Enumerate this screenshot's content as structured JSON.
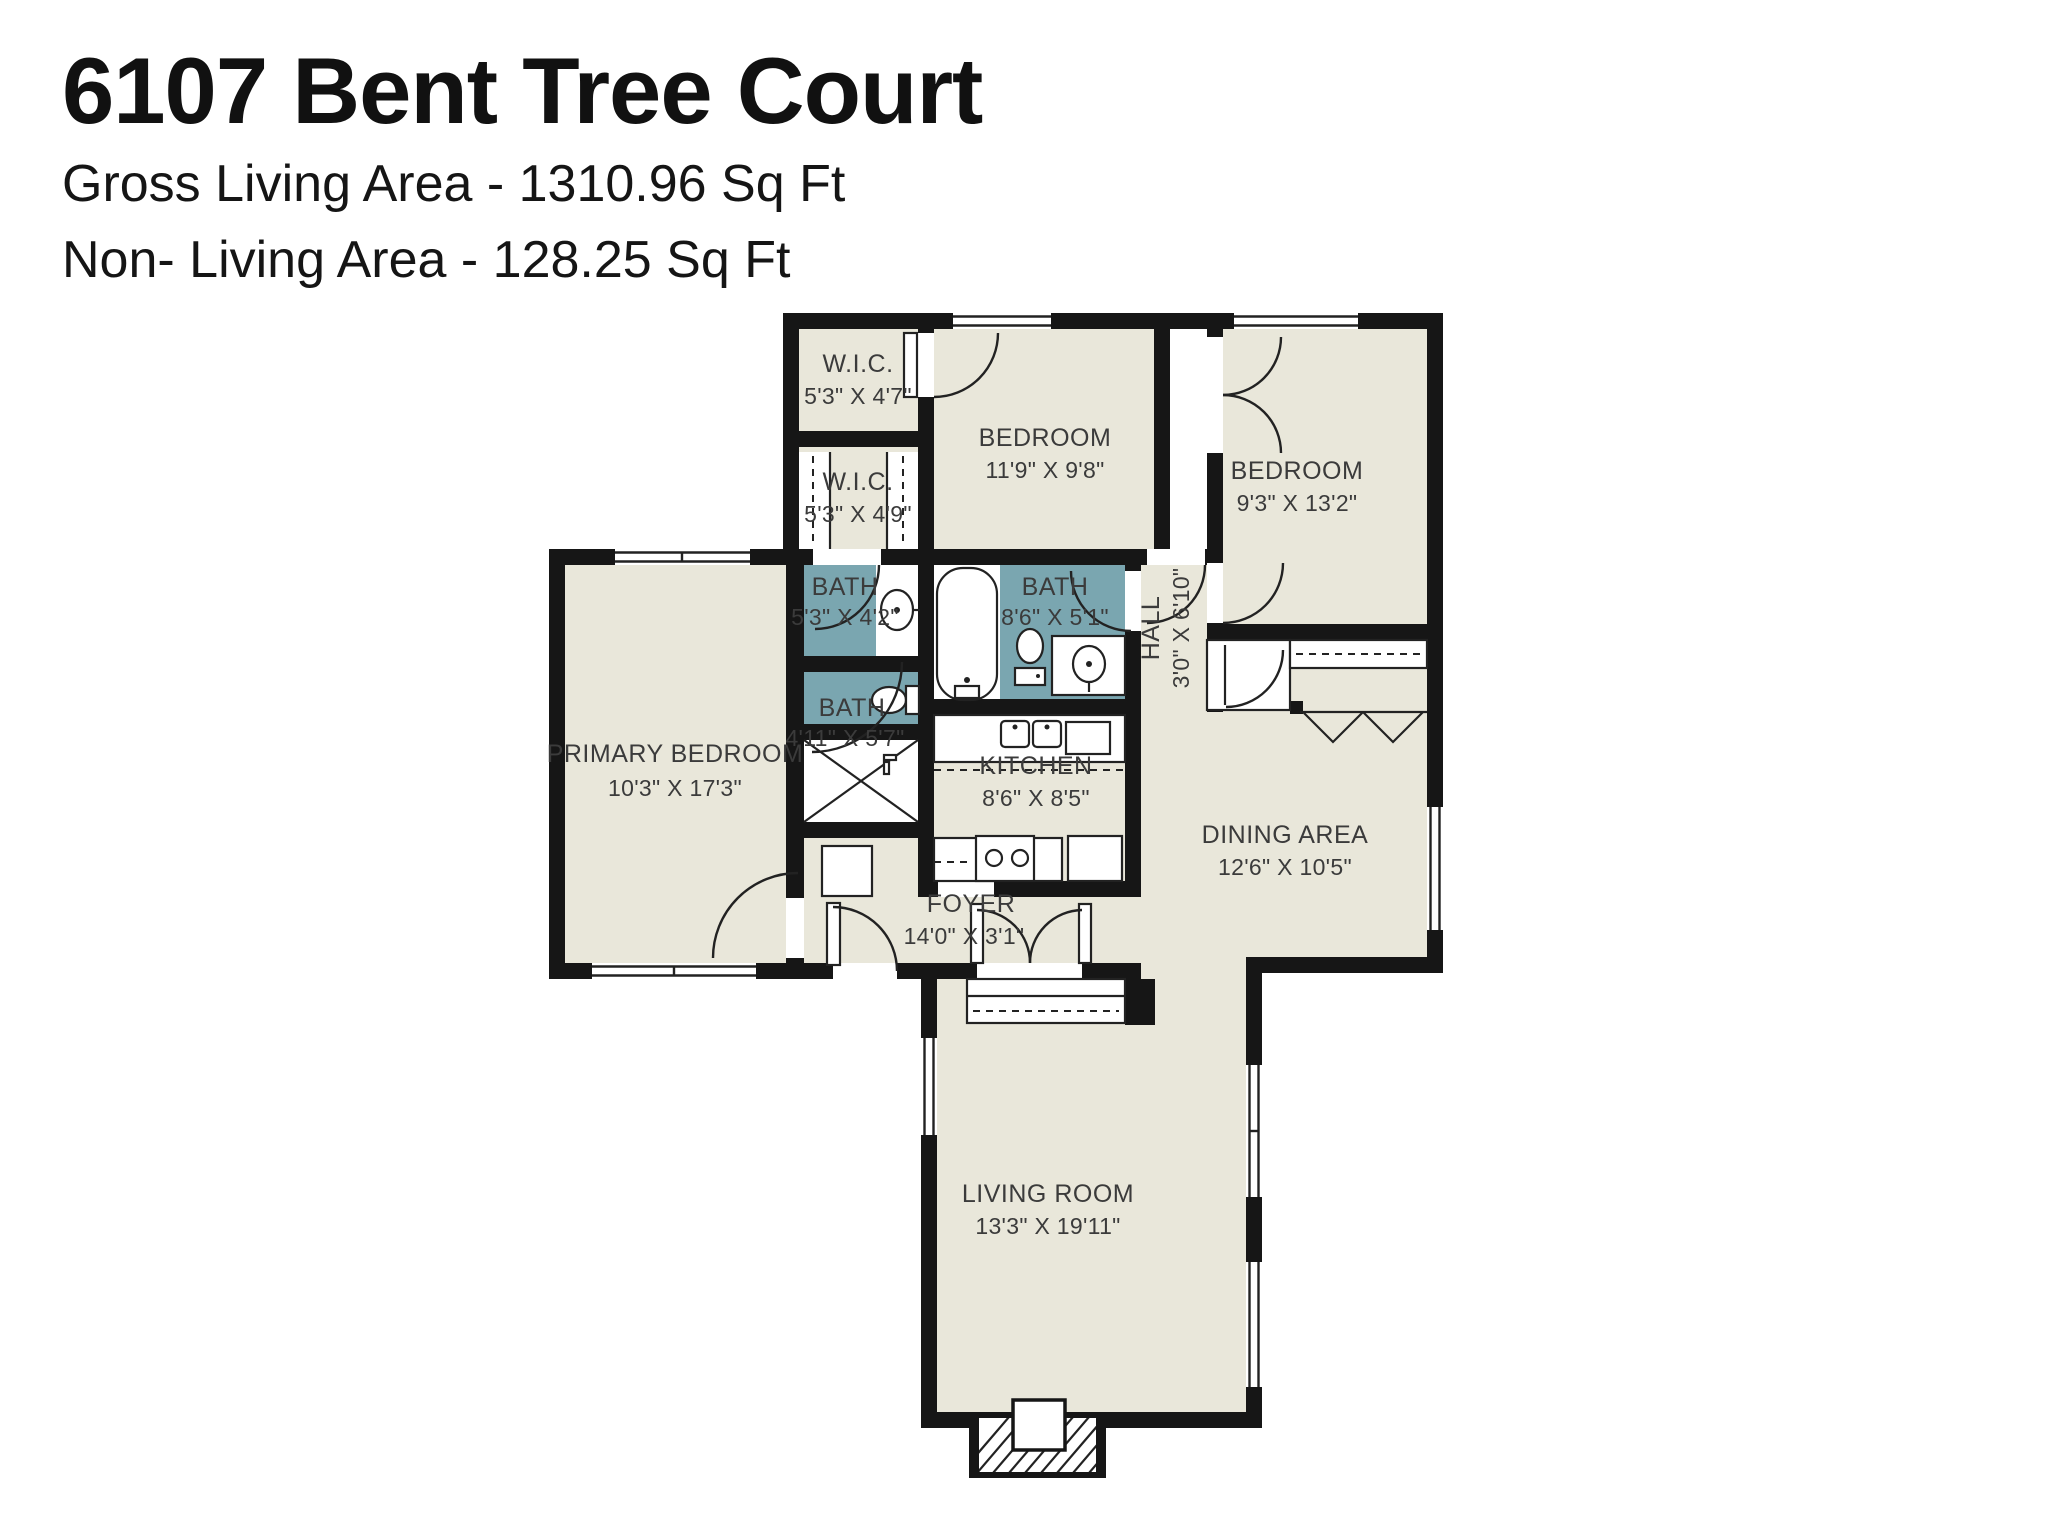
{
  "header": {
    "title": "6107 Bent Tree Court",
    "gross_line": "Gross Living Area - 1310.96 Sq Ft",
    "non_living_line": "Non- Living Area - 128.25 Sq Ft"
  },
  "colors": {
    "wall": "#161616",
    "floor": "#e9e7da",
    "bath_fill": "#7aa6b0",
    "label_text": "#3b3b3b",
    "background": "#ffffff"
  },
  "rooms": [
    {
      "id": "wic-upper",
      "name": "W.I.C.",
      "dims": "5'3\" X 4'7\""
    },
    {
      "id": "bedroom-top",
      "name": "BEDROOM",
      "dims": "11'9\" X 9'8\""
    },
    {
      "id": "bedroom-right",
      "name": "BEDROOM",
      "dims": "9'3\" X 13'2\""
    },
    {
      "id": "wic-lower",
      "name": "W.I.C.",
      "dims": "5'3\" X 4'9\""
    },
    {
      "id": "bath-hall",
      "name": "BATH",
      "dims": "5'3\" X 4'2\""
    },
    {
      "id": "bath-main",
      "name": "BATH",
      "dims": "8'6\" X 5'1\""
    },
    {
      "id": "hall",
      "name": "HALL",
      "dims": "3'0\" X 6'10\""
    },
    {
      "id": "bath-primary",
      "name": "BATH",
      "dims": "4'11\" X 5'7\""
    },
    {
      "id": "primary-bedroom",
      "name": "PRIMARY BEDROOM",
      "dims": "10'3\" X 17'3\""
    },
    {
      "id": "kitchen",
      "name": "KITCHEN",
      "dims": "8'6\" X 8'5\""
    },
    {
      "id": "dining",
      "name": "DINING AREA",
      "dims": "12'6\" X 10'5\""
    },
    {
      "id": "foyer",
      "name": "FOYER",
      "dims": "14'0\" X 3'1\""
    },
    {
      "id": "living",
      "name": "LIVING ROOM",
      "dims": "13'3\" X 19'11\""
    }
  ]
}
